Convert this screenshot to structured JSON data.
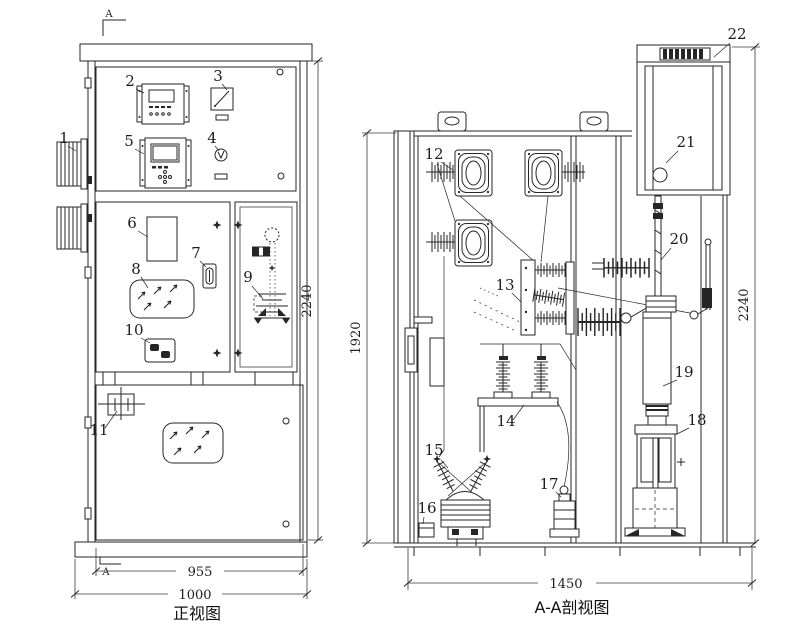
{
  "front_view": {
    "title": "正视图",
    "section_marker_top": "A",
    "section_marker_bottom": "A",
    "dim_inner_width": "955",
    "dim_outer_width": "1000",
    "dim_height": "2240",
    "callouts": [
      {
        "label": "1"
      },
      {
        "label": "2"
      },
      {
        "label": "3"
      },
      {
        "label": "4"
      },
      {
        "label": "5"
      },
      {
        "label": "6"
      },
      {
        "label": "7"
      },
      {
        "label": "8"
      },
      {
        "label": "9"
      },
      {
        "label": "10"
      },
      {
        "label": "11"
      }
    ]
  },
  "section_view": {
    "title": "A-A剖视图",
    "dim_width": "1450",
    "dim_inner_height": "1920",
    "dim_height": "2240",
    "callouts": [
      {
        "label": "12"
      },
      {
        "label": "13"
      },
      {
        "label": "14"
      },
      {
        "label": "15"
      },
      {
        "label": "16"
      },
      {
        "label": "17"
      },
      {
        "label": "18"
      },
      {
        "label": "19"
      },
      {
        "label": "20"
      },
      {
        "label": "21"
      },
      {
        "label": "22"
      }
    ]
  }
}
